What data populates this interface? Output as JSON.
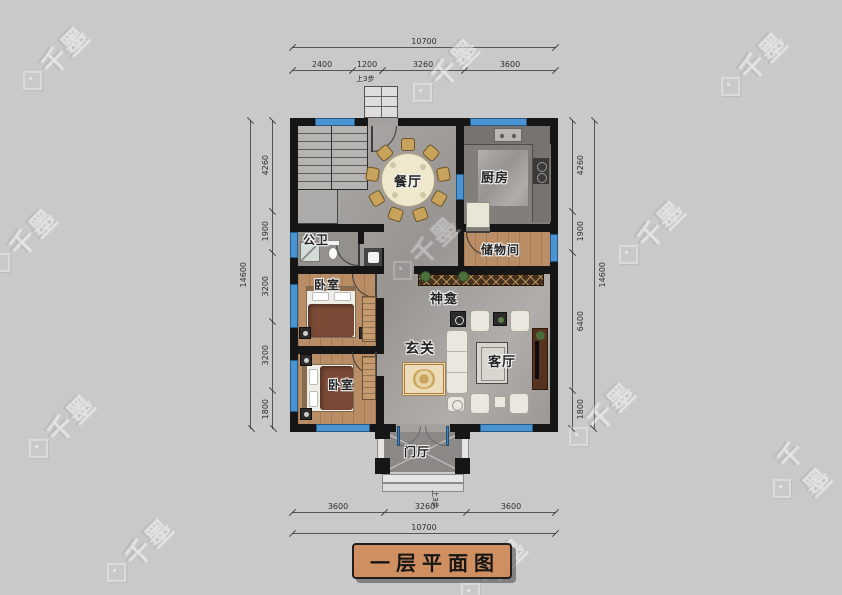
{
  "drawing_title": "一层平面图",
  "watermark_text": "千墨",
  "rooms": {
    "dining": "餐厅",
    "kitchen": "厨房",
    "bathroom": "公卫",
    "storage": "储物间",
    "bedroom_top": "卧室",
    "bedroom_bottom": "卧室",
    "shrine": "神龛",
    "foyer": "玄关",
    "living": "客厅",
    "porch": "门厅"
  },
  "annotations": {
    "steps_top": "上3步",
    "steps_bottom": "上3步"
  },
  "dimensions": {
    "top": {
      "overall": "10700",
      "segments": [
        "2400",
        "1200",
        "3260",
        "3600"
      ]
    },
    "bottom": {
      "overall": "10700",
      "segments": [
        "3600",
        "3260",
        "3600"
      ]
    },
    "left": {
      "overall": "14600",
      "segments": [
        "4260",
        "1900",
        "3200",
        "3200",
        "1800"
      ]
    },
    "right": {
      "overall": "14600",
      "segments": [
        "4260",
        "1900",
        "6400",
        "1800"
      ]
    }
  },
  "colors": {
    "background": "#c9c9c9",
    "wall": "#161616",
    "window_blue": "#4a94d4",
    "wood_floor": "#b98e66",
    "title_badge": "#cf8f60"
  }
}
